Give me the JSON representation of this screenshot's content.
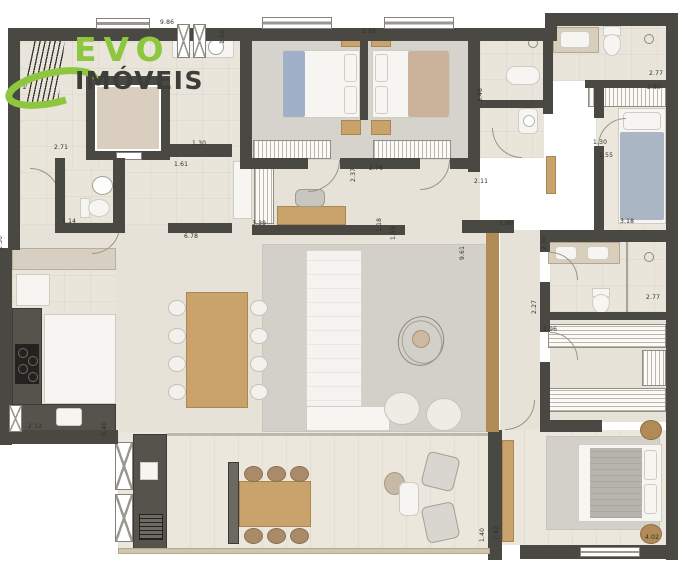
{
  "logo": {
    "brand": "EVO",
    "sub": "IMÓVEIS",
    "accent_green": "#8dc63f",
    "text_dark": "#3d3d3a"
  },
  "plan": {
    "wall_color": "#4a4842",
    "dimensions": [
      {
        "label": "9.86",
        "x": 160,
        "y": 20,
        "v": false
      },
      {
        "label": "1.50",
        "x": 226,
        "y": 38,
        "v": true
      },
      {
        "label": "2.95",
        "x": 362,
        "y": 29,
        "v": false
      },
      {
        "label": "1.71",
        "x": 12,
        "y": 85,
        "v": false
      },
      {
        "label": "2.71",
        "x": 54,
        "y": 145,
        "v": false
      },
      {
        "label": "1.30",
        "x": 192,
        "y": 141,
        "v": false
      },
      {
        "label": "1.61",
        "x": 174,
        "y": 162,
        "v": false
      },
      {
        "label": "1.14",
        "x": 62,
        "y": 219,
        "v": false
      },
      {
        "label": "1.36",
        "x": 4,
        "y": 244,
        "v": true
      },
      {
        "label": "6.78",
        "x": 184,
        "y": 234,
        "v": false
      },
      {
        "label": "3.39",
        "x": 252,
        "y": 221,
        "v": false
      },
      {
        "label": "2.37",
        "x": 357,
        "y": 176,
        "v": true
      },
      {
        "label": "2.76",
        "x": 369,
        "y": 166,
        "v": false
      },
      {
        "label": "1.18",
        "x": 383,
        "y": 226,
        "v": true
      },
      {
        "label": "1.55",
        "x": 397,
        "y": 234,
        "v": true
      },
      {
        "label": "3.48",
        "x": 484,
        "y": 96,
        "v": true
      },
      {
        "label": "2.11",
        "x": 474,
        "y": 179,
        "v": false
      },
      {
        "label": "1.30",
        "x": 593,
        "y": 140,
        "v": false
      },
      {
        "label": "1.55",
        "x": 599,
        "y": 153,
        "v": false
      },
      {
        "label": "2.77",
        "x": 649,
        "y": 71,
        "v": false
      },
      {
        "label": "2.80",
        "x": 647,
        "y": 85,
        "v": false
      },
      {
        "label": "1.00",
        "x": 499,
        "y": 221,
        "v": false
      },
      {
        "label": "9.61",
        "x": 466,
        "y": 254,
        "v": true
      },
      {
        "label": "2.70",
        "x": 548,
        "y": 244,
        "v": true
      },
      {
        "label": "3.18",
        "x": 620,
        "y": 219,
        "v": false
      },
      {
        "label": "2.27",
        "x": 538,
        "y": 308,
        "v": true
      },
      {
        "label": "2.96",
        "x": 543,
        "y": 327,
        "v": false
      },
      {
        "label": "2.77",
        "x": 646,
        "y": 295,
        "v": false
      },
      {
        "label": "2.12",
        "x": 28,
        "y": 424,
        "v": false
      },
      {
        "label": "0.40",
        "x": 108,
        "y": 430,
        "v": true
      },
      {
        "label": "1.40",
        "x": 486,
        "y": 536,
        "v": true
      },
      {
        "label": "7.42",
        "x": 500,
        "y": 534,
        "v": true
      },
      {
        "label": "4.02",
        "x": 645,
        "y": 535,
        "v": false
      }
    ]
  }
}
